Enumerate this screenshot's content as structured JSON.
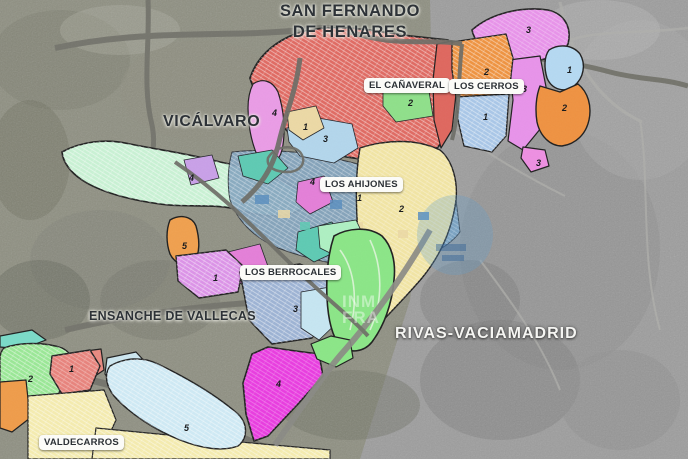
{
  "title_labels": {
    "san_fernando_line1": "SAN FERNANDO",
    "san_fernando_line2": "DE HENARES",
    "vicalvaro": "VICÁLVARO",
    "ensanche_vallecas": "ENSANCHE DE VALLECAS",
    "rivas_vaciamadrid": "RIVAS-VACIAMADRID"
  },
  "district_badges": [
    {
      "id": "el-canaveral",
      "label": "EL CAÑAVERAL"
    },
    {
      "id": "los-cerros",
      "label": "LOS CERROS"
    },
    {
      "id": "los-ahijones",
      "label": "LOS AHIJONES"
    },
    {
      "id": "los-berrocales",
      "label": "LOS BERROCALES"
    },
    {
      "id": "valdecarros",
      "label": "VALDECARROS"
    }
  ],
  "zone_numbers": [
    {
      "zone": "el-canaveral-green",
      "value": "2"
    },
    {
      "zone": "el-canaveral-violet",
      "value": "4"
    },
    {
      "zone": "el-canaveral-beige",
      "value": "1"
    },
    {
      "zone": "el-canaveral-blue",
      "value": "3"
    },
    {
      "zone": "los-cerros-magenta-north",
      "value": "3"
    },
    {
      "zone": "los-cerros-orange-grid",
      "value": "2"
    },
    {
      "zone": "los-cerros-magenta-mid",
      "value": "3"
    },
    {
      "zone": "los-cerros-blue-grid",
      "value": "1"
    },
    {
      "zone": "los-cerros-blue-east",
      "value": "1"
    },
    {
      "zone": "los-cerros-orange-east",
      "value": "2"
    },
    {
      "zone": "los-cerros-pink-south",
      "value": "3"
    },
    {
      "zone": "vicalvaro-mint",
      "value": "4"
    },
    {
      "zone": "los-ahijones-north",
      "value": "4"
    },
    {
      "zone": "los-ahijones-center",
      "value": "1"
    },
    {
      "zone": "los-ahijones-yellow",
      "value": "2"
    },
    {
      "zone": "los-ahijones-orange-west",
      "value": "5"
    },
    {
      "zone": "los-berrocales-violet",
      "value": "1"
    },
    {
      "zone": "los-berrocales-grid",
      "value": "3"
    },
    {
      "zone": "los-berrocales-magenta",
      "value": "4"
    },
    {
      "zone": "valdecarros-green",
      "value": "2"
    },
    {
      "zone": "valdecarros-salmon",
      "value": "1"
    },
    {
      "zone": "valdecarros-blue",
      "value": "5"
    }
  ],
  "zone_colors": {
    "canaveral_main": "#e06a62",
    "canaveral_green": "#8fe08a",
    "canaveral_violet": "#ea9ce6",
    "canaveral_blue": "#b3d6ec",
    "canaveral_beige": "#ecd9a5",
    "cerros_red_strip": "#df675e",
    "cerros_orange_grid": "#ef9340",
    "cerros_magenta": "#e893ea",
    "cerros_blue_grid": "#a9c7e8",
    "cerros_blue_east": "#b5d9f2",
    "cerros_orange_east": "#ef9241",
    "cerros_pink_south": "#ee8fe2",
    "vicalvaro_mint": "#c9f2d4",
    "urban_blue": "#84a5bf",
    "ahijones_yellow": "#f2e5a4",
    "ahijones_teal": "#5ecab3",
    "ahijones_magenta": "#e47fd8",
    "ahijones_orchid": "#c9a0e8",
    "ahijones_orange": "#f0a04e",
    "berrocales_violet": "#dc93e8",
    "berrocales_grid_blue": "#9db3d4",
    "berrocales_mint": "#aef0c2",
    "berrocales_pale_blue": "#c6e6f2",
    "berrocales_magenta": "#e93ce0",
    "park_green": "#8be687",
    "valdecarros_teal": "#7adbc8",
    "valdecarros_green": "#9ae896",
    "valdecarros_salmon": "#e8837c",
    "valdecarros_orange": "#ef9c4a",
    "valdecarros_yellow": "#f5ecaf",
    "valdecarros_blue": "#cfeaf5",
    "ensanche_blue": "#cde7f0",
    "ensanche_salmon": "#e88a80"
  },
  "base_colors": {
    "satellite_left": "#8e8f81",
    "satellite_right": "#9d9d9d",
    "road": "#6d6d66",
    "outline": "#1f1f1f",
    "badge_bg": "#fbfbf8",
    "badge_text": "#2c3136"
  },
  "watermark": {
    "line1": "INM",
    "line2": "FRA"
  }
}
